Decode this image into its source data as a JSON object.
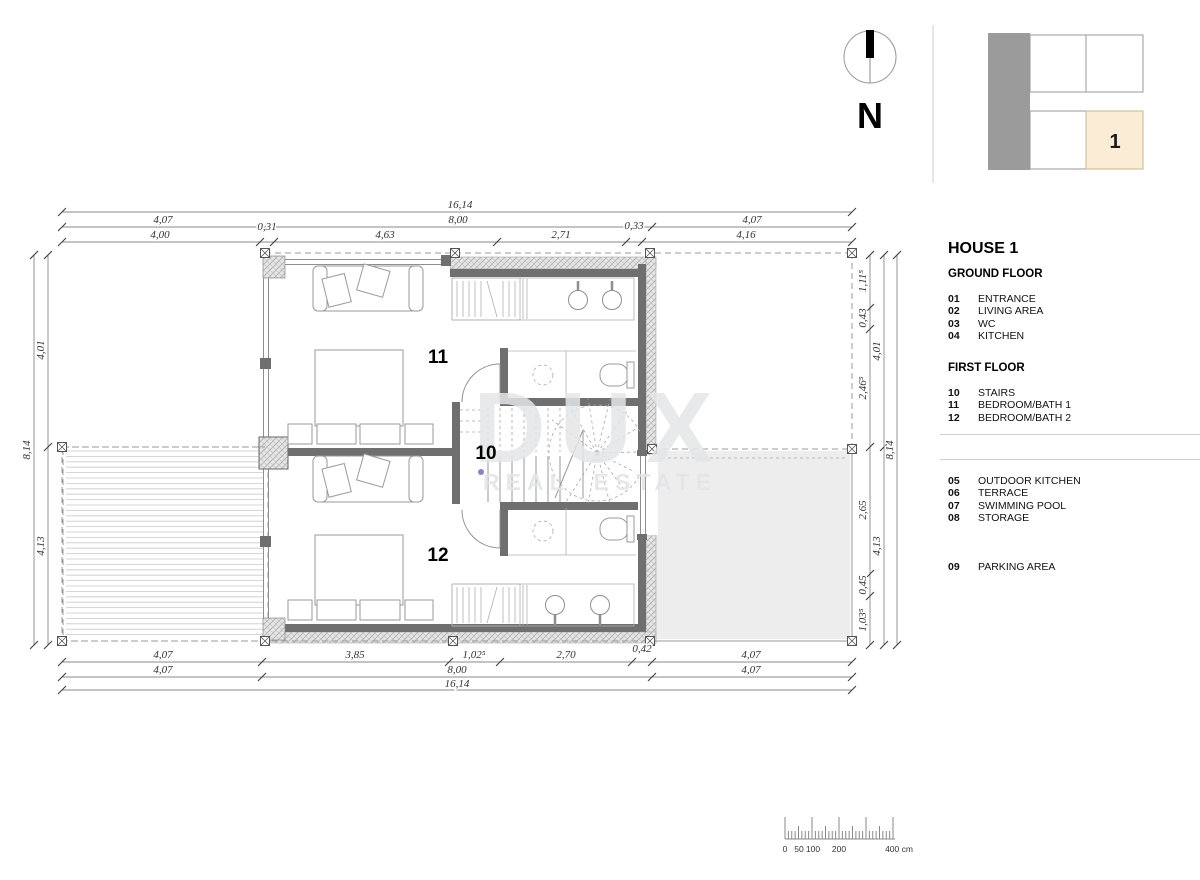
{
  "north": {
    "label": "N"
  },
  "key_plan": {
    "unit": "1"
  },
  "watermark": {
    "line1": "DUX",
    "line2": "REAL ESTATE"
  },
  "rooms": {
    "r10": "10",
    "r11": "11",
    "r12": "12"
  },
  "legend": {
    "title": "HOUSE 1",
    "ground": {
      "heading": "GROUND FLOOR",
      "items": [
        {
          "num": "01",
          "label": "ENTRANCE"
        },
        {
          "num": "02",
          "label": "LIVING AREA"
        },
        {
          "num": "03",
          "label": "WC"
        },
        {
          "num": "04",
          "label": "KITCHEN"
        }
      ]
    },
    "first": {
      "heading": "FIRST FLOOR",
      "items": [
        {
          "num": "10",
          "label": "STAIRS"
        },
        {
          "num": "11",
          "label": "BEDROOM/BATH 1"
        },
        {
          "num": "12",
          "label": "BEDROOM/BATH 2"
        }
      ]
    },
    "outdoor": {
      "items": [
        {
          "num": "05",
          "label": "OUTDOOR KITCHEN"
        },
        {
          "num": "06",
          "label": "TERRACE"
        },
        {
          "num": "07",
          "label": "SWIMMING POOL"
        },
        {
          "num": "08",
          "label": "STORAGE"
        }
      ]
    },
    "site": {
      "items": [
        {
          "num": "09",
          "label": "PARKING AREA"
        }
      ]
    }
  },
  "dims": {
    "top_total": "16,14",
    "top_mid": [
      "4,07",
      "8,00",
      "4,07"
    ],
    "top_inner": [
      "4,00",
      "0,31",
      "4,63",
      "2,71",
      "0,33",
      "4,16"
    ],
    "bottom_inner": [
      "4,07",
      "3,85",
      "1,02⁵",
      "2,70",
      "0,42",
      "4,07"
    ],
    "bottom_mid": [
      "4,07",
      "8,00",
      "4,07"
    ],
    "bottom_total": "16,14",
    "left_total": "8,14",
    "left_parts": [
      "4,01",
      "4,13"
    ],
    "right_total": "8,14",
    "right_parts": [
      "4,01",
      "4,13"
    ],
    "right_inner": [
      "1,11⁵",
      "0,43",
      "2,46⁵",
      "2,65",
      "0,45",
      "1,03⁵"
    ]
  },
  "scale_bar": {
    "labels": [
      "0",
      "50",
      "100",
      "200",
      "400 cm"
    ]
  }
}
